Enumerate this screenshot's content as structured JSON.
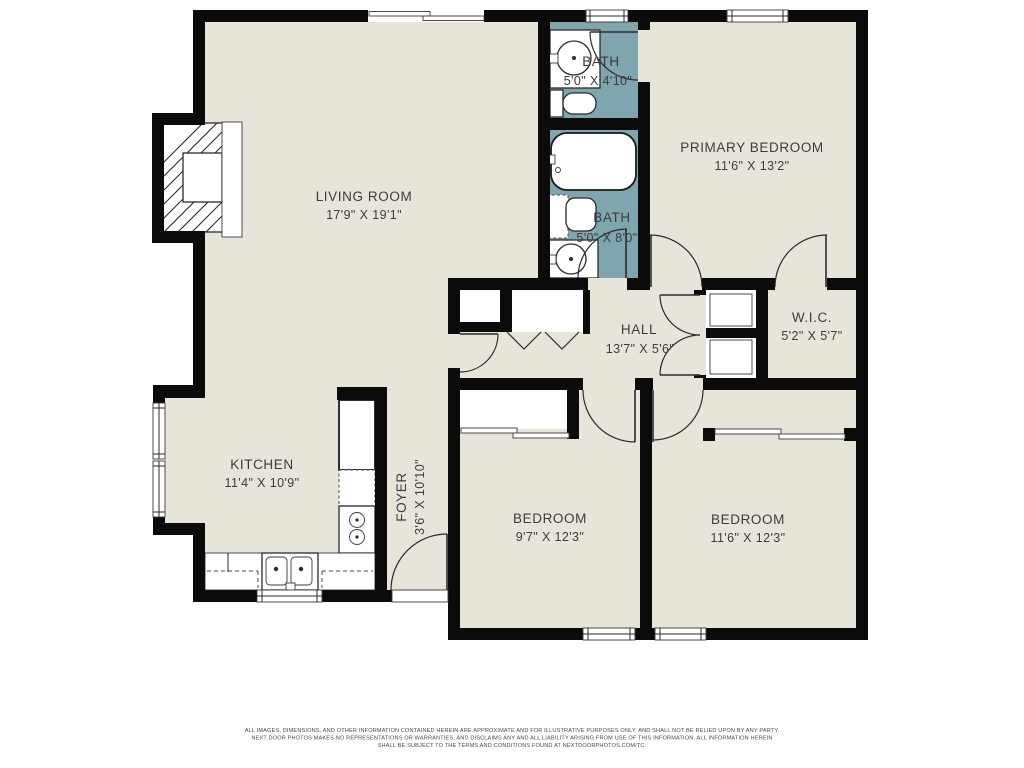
{
  "plan": {
    "type": "residential-floor-plan",
    "colors": {
      "floor": "#e7e5da",
      "bath_floor": "#7fa5ae",
      "walls": "#0b0b0b",
      "fixture_lines": "#2b2b2b",
      "label_text": "#3c3c3c",
      "background": "#ffffff"
    },
    "rooms": {
      "living_room": {
        "name": "LIVING ROOM",
        "dims": "17'9\" X 19'1\""
      },
      "kitchen": {
        "name": "KITCHEN",
        "dims": "11'4\" X 10'9\""
      },
      "foyer": {
        "name": "FOYER",
        "dims": "3'6\" X 10'10\""
      },
      "primary_bedroom": {
        "name": "PRIMARY BEDROOM",
        "dims": "11'6\" X 13'2\""
      },
      "bath_small": {
        "name": "BATH",
        "dims": "5'0\" X 4'10\""
      },
      "bath_large": {
        "name": "BATH",
        "dims": "5'0\" X 8'0\""
      },
      "hall": {
        "name": "HALL",
        "dims": "13'7\" X 5'6\""
      },
      "wic": {
        "name": "W.I.C.",
        "dims": "5'2\" X 5'7\""
      },
      "bedroom_left": {
        "name": "BEDROOM",
        "dims": "9'7\" X 12'3\""
      },
      "bedroom_right": {
        "name": "BEDROOM",
        "dims": "11'6\" X 12'3\""
      }
    },
    "disclaimer": {
      "line1": "ALL IMAGES, DIMENSIONS, AND OTHER INFORMATION CONTAINED HEREIN ARE APPROXIMATE AND FOR ILLUSTRATIVE PURPOSES ONLY, AND SHALL NOT BE RELIED UPON BY ANY PARTY.",
      "line2": "NEXT DOOR PHOTOS MAKES NO REPRESENTATIONS OR WARRANTIES, AND DISCLAIMS ANY AND ALL LIABILITY ARISING FROM USE OF THIS INFORMATION. ALL INFORMATION HEREIN",
      "line3": "SHALL BE SUBJECT TO THE TERMS AND CONDITIONS FOUND AT NEXTDOORPHOTOS.COM/TC."
    }
  }
}
